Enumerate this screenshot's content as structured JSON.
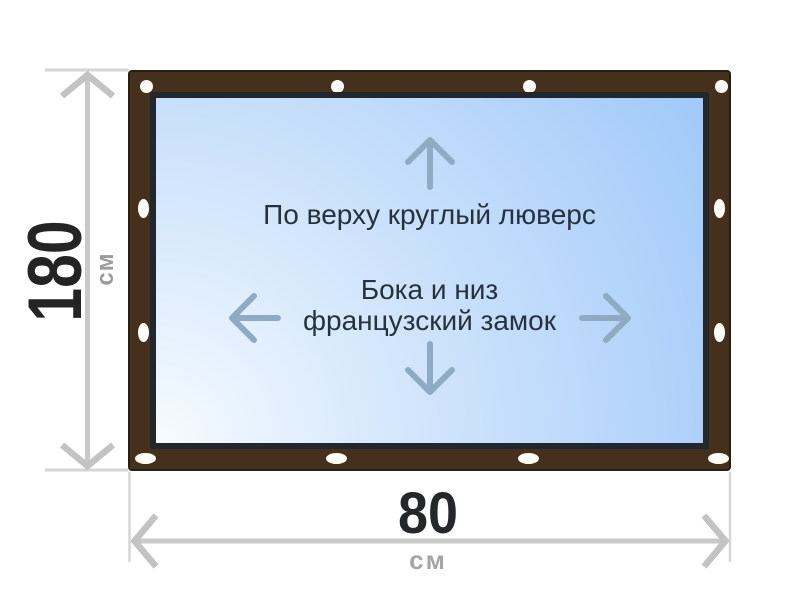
{
  "panel": {
    "top_note": "По верху круглый люверс",
    "middle_note_line1": "Бока и низ",
    "middle_note_line2": "французский замок"
  },
  "dimensions": {
    "height": {
      "value": "180",
      "unit": "см"
    },
    "width": {
      "value": "80",
      "unit": "см"
    }
  },
  "colors": {
    "frame_brown": "#45301e",
    "frame_outline": "#281e13",
    "panel_border": "#21272d",
    "panel_gradient_light": "#f6fbff",
    "panel_gradient_blue": "#9ac5fa",
    "panel_arrow": "#8fabc4",
    "note_text": "#26323e",
    "dimension_line": "#c8c8c8",
    "dimension_value_text": "#242424",
    "dimension_unit_text": "#9e9e9e",
    "grommet": "#fffdf6"
  }
}
